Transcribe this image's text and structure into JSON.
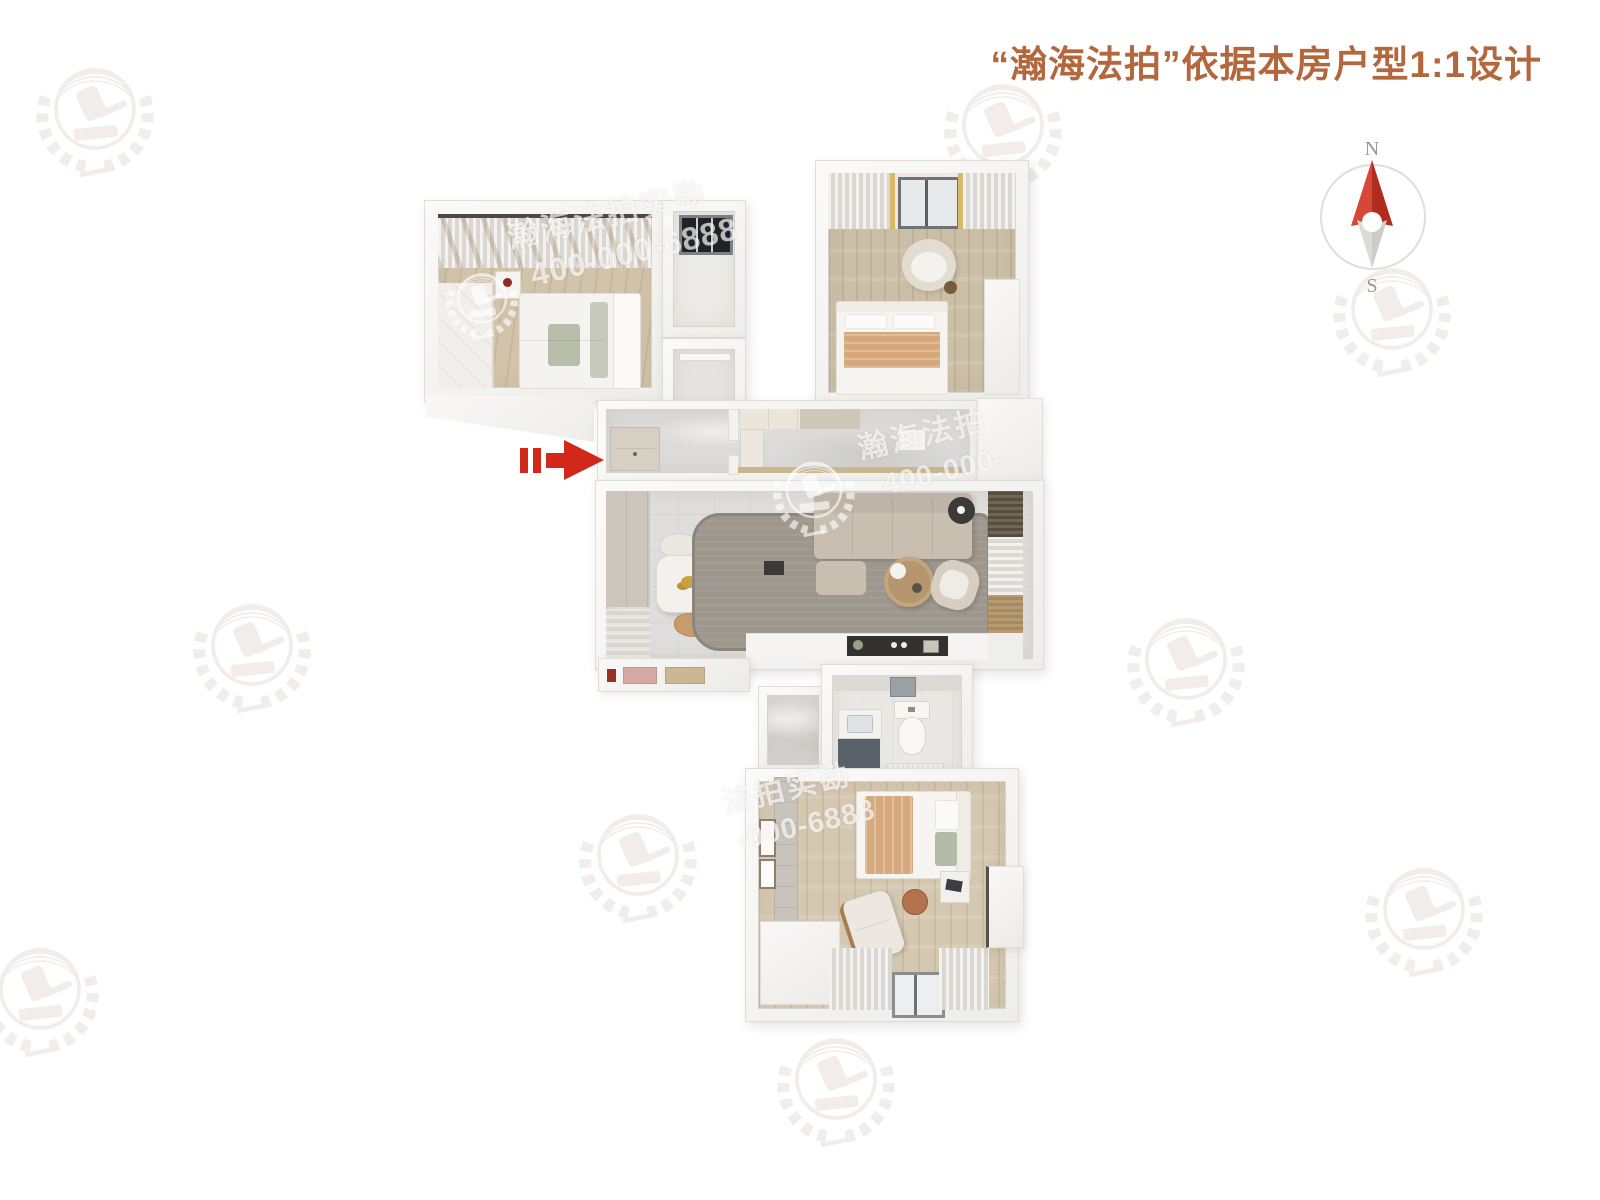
{
  "header": {
    "title": "“瀚海法拍”依据本房户型1:1设计"
  },
  "compass": {
    "north_label": "N",
    "south_label": "S"
  },
  "watermarks": {
    "plan_top": {
      "brand": "瀚海法拍实勘",
      "phone": "400-000-6888"
    },
    "plan_center": {
      "brand": "瀚海法拍",
      "phone": "400-000-"
    },
    "plan_bottom": {
      "brand": "法拍实勘",
      "phone": "-000-6888"
    }
  },
  "colors": {
    "title_text": "#b2673c",
    "entry_arrow_red": "#d2281a",
    "compass_north_red": "#c23b2a"
  }
}
